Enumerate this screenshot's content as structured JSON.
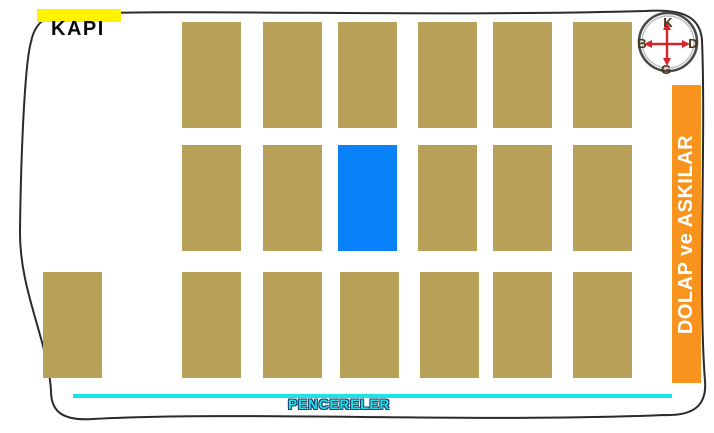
{
  "labels": {
    "door": "KAPI",
    "windows": "PENCERELER",
    "cabinet": "DOLAP ve ASKILAR"
  },
  "compass": {
    "north": "K",
    "south": "G",
    "west": "B",
    "east": "D"
  },
  "colors": {
    "desk": "#B7A159",
    "selected_desk": "#0981F8",
    "cabinet_bar": "#F8941E",
    "cabinet_text": "#FFFFFF",
    "door_highlight": "#FFF200",
    "door_text": "#0A0A0A",
    "window_line": "#1BE4E6",
    "window_text": "#1BE4E6",
    "window_text_outline": "#1D3A6E",
    "compass_arrow": "#D8232A",
    "compass_letter": "#45361A",
    "room_outline": "#2A2A2A"
  },
  "seating": {
    "desk_width": 59,
    "desk_height": 106,
    "selected_count": 1,
    "total_desks": 19,
    "rows": [
      {
        "y": 22,
        "desks": [
          {
            "x": 182
          },
          {
            "x": 263
          },
          {
            "x": 338
          },
          {
            "x": 418
          },
          {
            "x": 493
          },
          {
            "x": 573
          }
        ]
      },
      {
        "y": 145,
        "desks": [
          {
            "x": 182
          },
          {
            "x": 263
          },
          {
            "x": 338,
            "selected": true
          },
          {
            "x": 418
          },
          {
            "x": 493
          },
          {
            "x": 573
          }
        ]
      },
      {
        "y": 272,
        "desks": [
          {
            "x": 43
          },
          {
            "x": 182
          },
          {
            "x": 263
          },
          {
            "x": 340
          },
          {
            "x": 420
          },
          {
            "x": 493
          },
          {
            "x": 573
          }
        ]
      }
    ]
  }
}
